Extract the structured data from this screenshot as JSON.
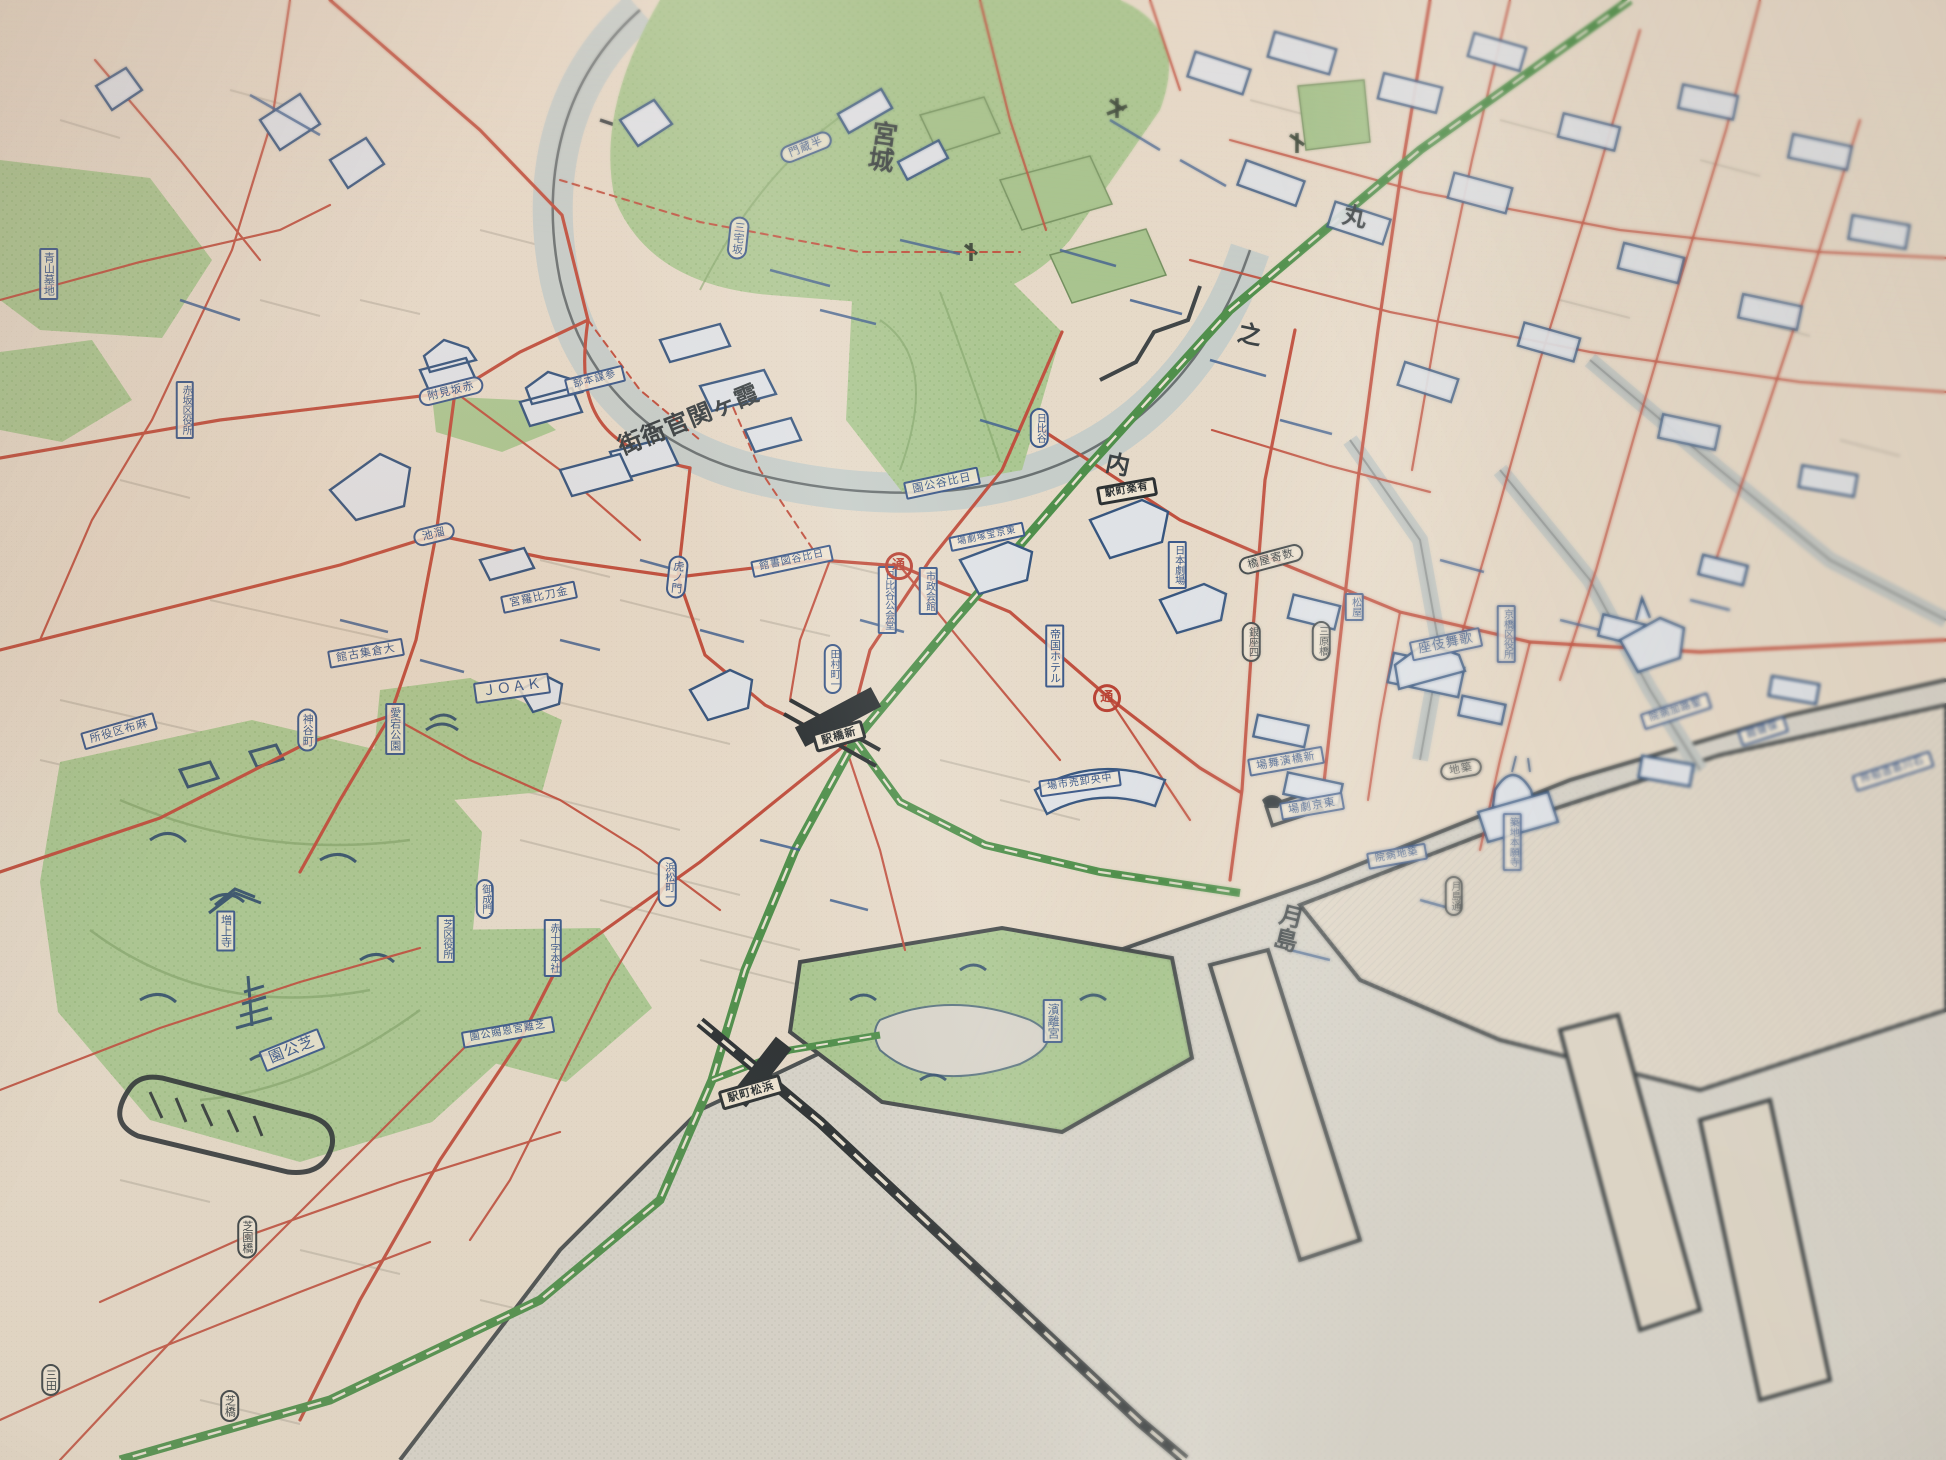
{
  "map": {
    "kind": "vintage pictorial street map photograph (central Tokyo)",
    "palette": {
      "paper": "#e6dac9",
      "ink_blue": "#3d5a8a",
      "ink_dark": "#3a4144",
      "road_red": "#c0503f",
      "park_green": "#abc792",
      "rail_green": "#4f8f4b",
      "water_gray": "#d6d3c9",
      "moat_gray": "#c4cbc7",
      "station_black": "#2c3133"
    },
    "district_titles": [
      {
        "id": "district-kyujo",
        "text": "宮城",
        "shape": "plain",
        "orient": "v",
        "x": 45.2,
        "y": 10.0,
        "rot": 8,
        "size": 26,
        "ink": "dark"
      },
      {
        "id": "district-kasumigaseki",
        "text": "霞ヶ関官衙街",
        "shape": "plain",
        "orient": "h-rtl",
        "x": 35.4,
        "y": 28.8,
        "rot": -22,
        "size": 24,
        "ink": "dark"
      },
      {
        "id": "district-maru",
        "text": "丸",
        "shape": "plain",
        "orient": "v",
        "x": 69.5,
        "y": 14.7,
        "rot": 12,
        "size": 24,
        "ink": "dark"
      },
      {
        "id": "district-no",
        "text": "之",
        "shape": "plain",
        "orient": "v",
        "x": 64.1,
        "y": 22.8,
        "rot": 12,
        "size": 24,
        "ink": "dark"
      },
      {
        "id": "district-uchi",
        "text": "内",
        "shape": "plain",
        "orient": "v",
        "x": 57.3,
        "y": 31.7,
        "rot": 12,
        "size": 24,
        "ink": "dark"
      },
      {
        "id": "district-tsukishima",
        "text": "月島",
        "shape": "plain",
        "orient": "v",
        "x": 66.1,
        "y": 63.5,
        "rot": 14,
        "size": 24,
        "ink": "dark"
      }
    ],
    "labels": [
      {
        "id": "label-aoyama-bochi",
        "text": "青山墓地",
        "shape": "rect",
        "orient": "v",
        "x": 2.5,
        "y": 18.8,
        "rot": 0,
        "size": 11
      },
      {
        "id": "label-akasaka-kuyakusho",
        "text": "赤坂区役所",
        "shape": "rect",
        "orient": "v",
        "x": 9.5,
        "y": 28.1,
        "rot": 0,
        "size": 10
      },
      {
        "id": "label-akasaka-mitsuke",
        "text": "赤坂見附",
        "shape": "oval",
        "orient": "h-rtl",
        "x": 23.2,
        "y": 26.8,
        "rot": -14,
        "size": 11
      },
      {
        "id": "label-miyakezaka",
        "text": "三宅坂",
        "shape": "oval",
        "orient": "v",
        "x": 37.9,
        "y": 16.3,
        "rot": 6,
        "size": 11
      },
      {
        "id": "label-hanzomon",
        "text": "半蔵門",
        "shape": "oval",
        "orient": "h-rtl",
        "x": 41.4,
        "y": 10.1,
        "rot": -22,
        "size": 11
      },
      {
        "id": "label-sanbo-honbu",
        "text": "参謀本部",
        "shape": "rect",
        "orient": "h-rtl",
        "x": 30.6,
        "y": 26.0,
        "rot": -14,
        "size": 10
      },
      {
        "id": "label-tameike",
        "text": "溜池",
        "shape": "oval",
        "orient": "h-rtl",
        "x": 22.3,
        "y": 36.6,
        "rot": -14,
        "size": 11
      },
      {
        "id": "label-kotohiragu",
        "text": "金刀比羅宮",
        "shape": "rect",
        "orient": "h-rtl",
        "x": 27.7,
        "y": 40.9,
        "rot": -12,
        "size": 11
      },
      {
        "id": "label-toranomon",
        "text": "虎ノ門",
        "shape": "oval",
        "orient": "v",
        "x": 34.8,
        "y": 39.5,
        "rot": 6,
        "size": 11
      },
      {
        "id": "label-okura-shukokan",
        "text": "大倉集古館",
        "shape": "rect",
        "orient": "h-rtl",
        "x": 18.8,
        "y": 44.7,
        "rot": -10,
        "size": 11
      },
      {
        "id": "label-joak",
        "text": "ＪＯＡＫ",
        "shape": "rect",
        "orient": "h",
        "x": 26.3,
        "y": 47.1,
        "rot": -8,
        "size": 14
      },
      {
        "id": "label-atago-koen",
        "text": "愛宕公園",
        "shape": "rect",
        "orient": "v",
        "x": 20.3,
        "y": 49.9,
        "rot": 0,
        "size": 11
      },
      {
        "id": "label-kamiyacho",
        "text": "神谷町",
        "shape": "oval",
        "orient": "v",
        "x": 15.8,
        "y": 50.0,
        "rot": 0,
        "size": 11
      },
      {
        "id": "label-azabu-kuyakusho",
        "text": "麻布区役所",
        "shape": "rect",
        "orient": "h-rtl",
        "x": 6.1,
        "y": 50.1,
        "rot": -16,
        "size": 11
      },
      {
        "id": "label-zojoji",
        "text": "増上寺",
        "shape": "rect",
        "orient": "v",
        "x": 11.6,
        "y": 63.8,
        "rot": 0,
        "size": 11
      },
      {
        "id": "label-onarimon",
        "text": "御成門",
        "shape": "oval",
        "orient": "v",
        "x": 24.9,
        "y": 61.6,
        "rot": 0,
        "size": 10
      },
      {
        "id": "label-shiba-kuyakusho",
        "text": "芝区役所",
        "shape": "rect",
        "orient": "v",
        "x": 22.9,
        "y": 64.3,
        "rot": 0,
        "size": 10
      },
      {
        "id": "label-sekijuji-honsha",
        "text": "赤十字本社",
        "shape": "rect",
        "orient": "v",
        "x": 28.4,
        "y": 64.9,
        "rot": 0,
        "size": 10
      },
      {
        "id": "label-hamamatsucho-1",
        "text": "浜松町一",
        "shape": "oval",
        "orient": "v",
        "x": 34.3,
        "y": 60.4,
        "rot": 0,
        "size": 10
      },
      {
        "id": "label-shiba-koen",
        "text": "芝公園",
        "shape": "rect",
        "orient": "h-rtl",
        "x": 15.0,
        "y": 71.9,
        "rot": -22,
        "size": 15
      },
      {
        "id": "label-shiba-rikyu",
        "text": "芝離宮恩賜公園",
        "shape": "rect",
        "orient": "h-rtl",
        "x": 26.1,
        "y": 70.7,
        "rot": -10,
        "size": 10
      },
      {
        "id": "label-shibaenbashi",
        "text": "芝園橋",
        "shape": "oval",
        "orient": "v",
        "x": 12.7,
        "y": 84.7,
        "rot": 0,
        "size": 11,
        "ink": "dark"
      },
      {
        "id": "label-mita",
        "text": "三田",
        "shape": "oval",
        "orient": "v",
        "x": 2.6,
        "y": 94.5,
        "rot": 0,
        "size": 11,
        "ink": "dark"
      },
      {
        "id": "label-shibabashi",
        "text": "芝橋",
        "shape": "oval",
        "orient": "v",
        "x": 11.8,
        "y": 96.3,
        "rot": 0,
        "size": 11,
        "ink": "dark"
      },
      {
        "id": "label-hamamatsucho-eki",
        "text": "浜松町駅",
        "shape": "station",
        "orient": "h-rtl",
        "x": 38.6,
        "y": 74.8,
        "rot": -16,
        "size": 11
      },
      {
        "id": "label-hamarikyu",
        "text": "濱離宮",
        "shape": "rect",
        "orient": "v",
        "x": 54.1,
        "y": 69.9,
        "rot": 0,
        "size": 12
      },
      {
        "id": "label-tamuracho-1",
        "text": "田村町一",
        "shape": "oval",
        "orient": "v",
        "x": 42.8,
        "y": 45.8,
        "rot": 0,
        "size": 10
      },
      {
        "id": "label-shinbashi-eki",
        "text": "新橋駅",
        "shape": "station",
        "orient": "h-rtl",
        "x": 43.1,
        "y": 50.4,
        "rot": -16,
        "size": 11
      },
      {
        "id": "label-hibiya-toshokan",
        "text": "日比谷図書館",
        "shape": "rect",
        "orient": "h-rtl",
        "x": 40.7,
        "y": 38.4,
        "rot": -12,
        "size": 10
      },
      {
        "id": "label-hibiya-kokaido",
        "text": "日比谷公会堂",
        "shape": "rect",
        "orient": "v",
        "x": 45.6,
        "y": 41.1,
        "rot": 0,
        "size": 10
      },
      {
        "id": "label-shisei-kaikan",
        "text": "市政会館",
        "shape": "rect",
        "orient": "v",
        "x": 47.7,
        "y": 40.5,
        "rot": 0,
        "size": 10
      },
      {
        "id": "label-hibiya-koen",
        "text": "日比谷公園",
        "shape": "rect",
        "orient": "h-rtl",
        "x": 48.4,
        "y": 33.1,
        "rot": -12,
        "size": 11
      },
      {
        "id": "label-hibiya",
        "text": "日比谷",
        "shape": "oval",
        "orient": "v",
        "x": 53.4,
        "y": 29.3,
        "rot": 0,
        "size": 10
      },
      {
        "id": "label-yurakucho-eki",
        "text": "有楽町駅",
        "shape": "station",
        "orient": "h-rtl",
        "x": 57.9,
        "y": 33.6,
        "rot": -10,
        "size": 10
      },
      {
        "id": "label-takarazuka",
        "text": "東京宝塚劇場",
        "shape": "rect",
        "orient": "h-rtl",
        "x": 50.7,
        "y": 36.8,
        "rot": -12,
        "size": 9
      },
      {
        "id": "label-teikoku-hotel",
        "text": "帝国ホテル",
        "shape": "rect",
        "orient": "v",
        "x": 54.2,
        "y": 44.9,
        "rot": 0,
        "size": 11
      },
      {
        "id": "label-nihon-gekijo",
        "text": "日本劇場",
        "shape": "rect",
        "orient": "v",
        "x": 60.5,
        "y": 38.7,
        "rot": 0,
        "size": 10
      },
      {
        "id": "label-sukiyabashi",
        "text": "数寄屋橋",
        "shape": "oval",
        "orient": "h-rtl",
        "x": 65.3,
        "y": 38.3,
        "rot": -15,
        "size": 11,
        "ink": "dark"
      },
      {
        "id": "label-ginza-4",
        "text": "銀座四",
        "shape": "oval",
        "orient": "v",
        "x": 64.3,
        "y": 44.0,
        "rot": 0,
        "size": 10,
        "ink": "dark"
      },
      {
        "id": "label-miharabashi",
        "text": "三原橋",
        "shape": "oval",
        "orient": "v",
        "x": 67.9,
        "y": 43.9,
        "rot": 0,
        "size": 10,
        "ink": "dark"
      },
      {
        "id": "label-matsuya",
        "text": "松屋",
        "shape": "rect",
        "orient": "v",
        "x": 69.6,
        "y": 41.6,
        "rot": 0,
        "size": 10
      },
      {
        "id": "label-kabukiza",
        "text": "歌舞伎座",
        "shape": "rect",
        "orient": "h-rtl",
        "x": 74.3,
        "y": 44.1,
        "rot": -12,
        "size": 13
      },
      {
        "id": "label-kyobashi-kuyakusho",
        "text": "京橋区役所",
        "shape": "rect",
        "orient": "v",
        "x": 77.4,
        "y": 43.4,
        "rot": 0,
        "size": 10
      },
      {
        "id": "label-enbujo",
        "text": "新橋演舞場",
        "shape": "rect",
        "orient": "h-rtl",
        "x": 66.1,
        "y": 52.1,
        "rot": -10,
        "size": 11
      },
      {
        "id": "label-tokyo-gekijo",
        "text": "東京劇場",
        "shape": "rect",
        "orient": "h-rtl",
        "x": 67.4,
        "y": 55.2,
        "rot": -10,
        "size": 11
      },
      {
        "id": "label-tsukiji",
        "text": "築地",
        "shape": "oval",
        "orient": "h-rtl",
        "x": 75.1,
        "y": 52.7,
        "rot": -10,
        "size": 11,
        "ink": "dark"
      },
      {
        "id": "label-tsukiji-byoin",
        "text": "築地病院",
        "shape": "rect",
        "orient": "h-rtl",
        "x": 71.8,
        "y": 58.6,
        "rot": -10,
        "size": 10
      },
      {
        "id": "label-honganji",
        "text": "築地本願寺",
        "shape": "rect",
        "orient": "v",
        "x": 77.7,
        "y": 57.7,
        "rot": 0,
        "size": 10
      },
      {
        "id": "label-seiroka-byoin",
        "text": "聖路加病院",
        "shape": "rect",
        "orient": "h-rtl",
        "x": 86.1,
        "y": 48.7,
        "rot": -18,
        "size": 10
      },
      {
        "id": "label-hokenkan",
        "text": "保健館",
        "shape": "rect",
        "orient": "h-rtl",
        "x": 90.6,
        "y": 50.1,
        "rot": -18,
        "size": 10
      },
      {
        "id": "label-ishikawajima",
        "text": "石川島造船所",
        "shape": "rect",
        "orient": "h-rtl",
        "x": 97.3,
        "y": 52.8,
        "rot": -18,
        "size": 10
      },
      {
        "id": "label-tsukishima-dori",
        "text": "月島通",
        "shape": "oval",
        "orient": "v",
        "x": 74.7,
        "y": 61.4,
        "rot": 0,
        "size": 10,
        "ink": "dark"
      },
      {
        "id": "label-chuo-oroshiuri",
        "text": "中央卸売市場",
        "shape": "rect",
        "orient": "h-rtl",
        "x": 55.5,
        "y": 53.6,
        "rot": -8,
        "size": 10
      }
    ],
    "route_marks": [
      {
        "id": "mark-dori-1",
        "text": "通",
        "shape": "red-circle",
        "orient": "h",
        "x": 46.2,
        "y": 38.8,
        "rot": 0,
        "size": 13
      },
      {
        "id": "mark-dori-2",
        "text": "通",
        "shape": "red-circle",
        "orient": "h",
        "x": 56.9,
        "y": 47.8,
        "rot": 0,
        "size": 13
      }
    ]
  }
}
